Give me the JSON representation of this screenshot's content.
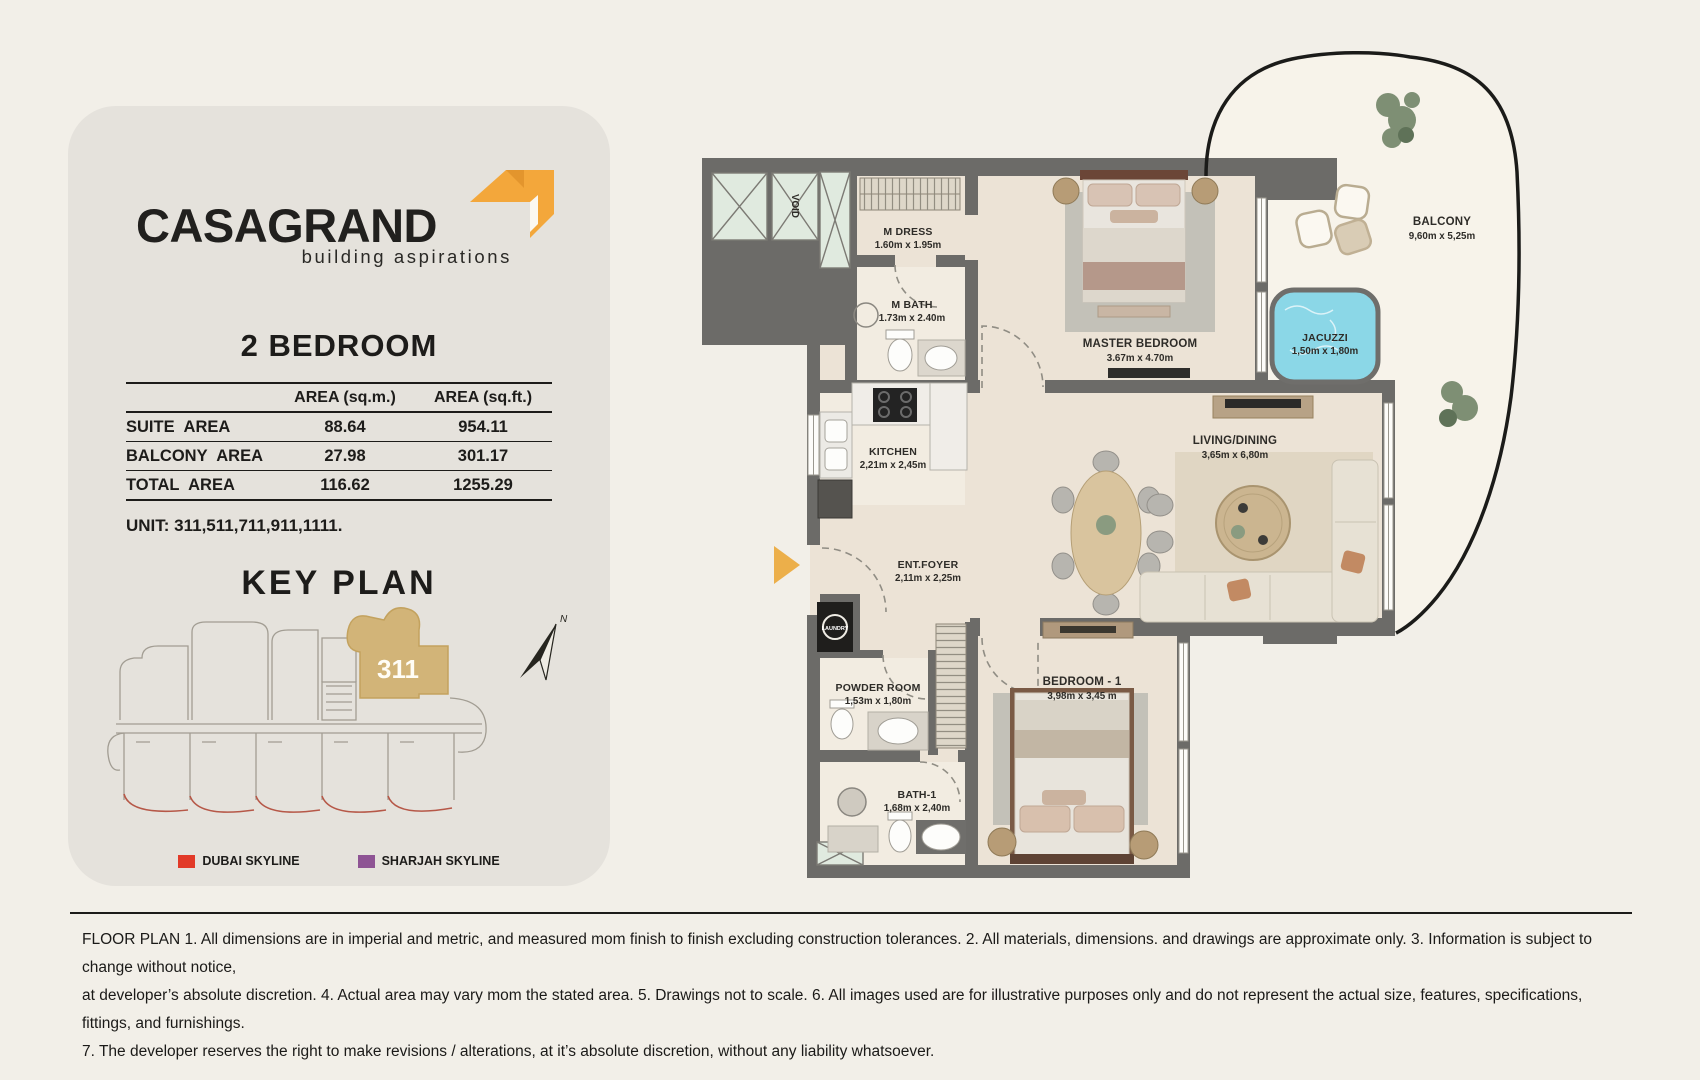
{
  "card": {
    "logo": {
      "brand": "CASAGRAND",
      "tagline": "building aspirations",
      "accent": "#f3a73b"
    },
    "heading": "2 BEDROOM",
    "table": {
      "col1": "AREA (sq.m.)",
      "col2": "AREA (sq.ft.)",
      "rows": [
        {
          "label": "SUITE AREA",
          "sqm": "88.64",
          "sqft": "954.11"
        },
        {
          "label": "BALCONY AREA",
          "sqm": "27.98",
          "sqft": "301.17"
        },
        {
          "label": "TOTAL AREA",
          "sqm": "116.62",
          "sqft": "1255.29"
        }
      ]
    },
    "unit_line": "UNIT: 311,511,711,911,1111.",
    "key_plan": {
      "title": "KEY PLAN",
      "highlight_unit": "311",
      "highlight_color": "#d2b478",
      "north": "N",
      "legend": [
        {
          "label": "DUBAI SKYLINE",
          "color": "#e23a28"
        },
        {
          "label": "SHARJAH SKYLINE",
          "color": "#8e5494"
        }
      ]
    }
  },
  "floorplan": {
    "rooms": {
      "mdress": {
        "name": "M DRESS",
        "dims": "1.60m x 1.95m"
      },
      "mbath": {
        "name": "M BATH",
        "dims": "1.73m x 2.40m"
      },
      "master": {
        "name": "MASTER BEDROOM",
        "dims": "3.67m x 4.70m"
      },
      "balcony": {
        "name": "BALCONY",
        "dims": "9,60m x 5,25m"
      },
      "jacuzzi": {
        "name": "JACUZZI",
        "dims": "1,50m x 1,80m"
      },
      "kitchen": {
        "name": "KITCHEN",
        "dims": "2,21m x 2,45m"
      },
      "living": {
        "name": "LIVING/DINING",
        "dims": "3,65m x 6,80m"
      },
      "foyer": {
        "name": "ENT.FOYER",
        "dims": "2,11m x 2,25m"
      },
      "powder": {
        "name": "POWDER ROOM",
        "dims": "1,53m x 1,80m"
      },
      "bedroom1": {
        "name": "BEDROOM - 1",
        "dims": "3,98m x 3,45 m"
      },
      "bath1": {
        "name": "BATH-1",
        "dims": "1,68m x 2,40m"
      }
    },
    "labels": {
      "void": "VOID",
      "laundry": "LAUNDRY"
    },
    "colors": {
      "wall": "#6c6b68",
      "floor": "#ece3d6",
      "balcony_floor": "#f7f3ea",
      "jacuzzi": "#8bd7e7",
      "shaft": "#e0eadf",
      "entry_arrow": "#ecaf4a"
    }
  },
  "footer": {
    "line1": "FLOOR PLAN 1. All dimensions are in imperial and metric, and measured mom finish to finish excluding construction tolerances. 2. All materials, dimensions. and drawings are approximate only. 3. Information is subject to change without notice,",
    "line2": "at developer’s absolute discretion. 4. Actual area may vary mom the stated area. 5. Drawings not to scale. 6. All images used are for illustrative purposes only and do not represent the actual size, features, specifications, fittings, and furnishings.",
    "line3": "7. The developer reserves the right to make revisions / alterations, at it’s absolute discretion, without any liability whatsoever."
  }
}
